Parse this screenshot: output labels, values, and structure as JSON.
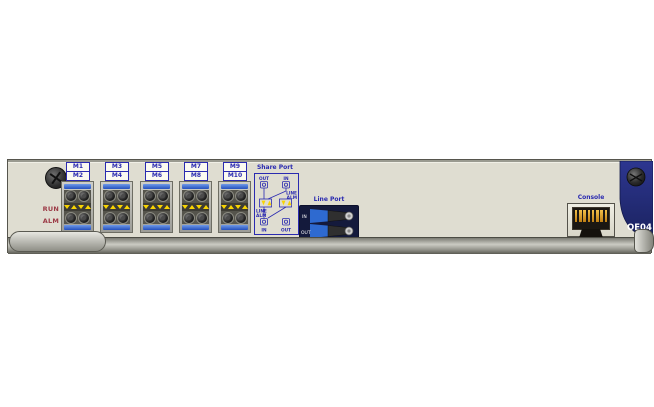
{
  "board": {
    "model": "OE04"
  },
  "leds": {
    "run": "RUN",
    "alm": "ALM"
  },
  "ports": [
    {
      "top": "M1",
      "bottom": "M2"
    },
    {
      "top": "M3",
      "bottom": "M4"
    },
    {
      "top": "M5",
      "bottom": "M6"
    },
    {
      "top": "M7",
      "bottom": "M8"
    },
    {
      "top": "M9",
      "bottom": "M10"
    }
  ],
  "share_port": {
    "title": "Share Port",
    "top_left": "OUT",
    "top_right": "IN",
    "right_line1": "LINE",
    "right_line2": "ALM",
    "left_line1": "LINE",
    "left_line2": "ALM",
    "bottom_left": "IN",
    "bottom_right": "OUT"
  },
  "line_port": {
    "title": "Line Port",
    "label_in": "IN",
    "label_out": "OUT"
  },
  "console": {
    "label": "Console"
  },
  "colors": {
    "faceplate": "#dfddd1",
    "navy": "#272f7c",
    "label_blue": "#2a2ab0",
    "laser_yellow": "#f8d402",
    "led_green": "#2db82d",
    "dust_cap_blue": "#2450bd"
  }
}
